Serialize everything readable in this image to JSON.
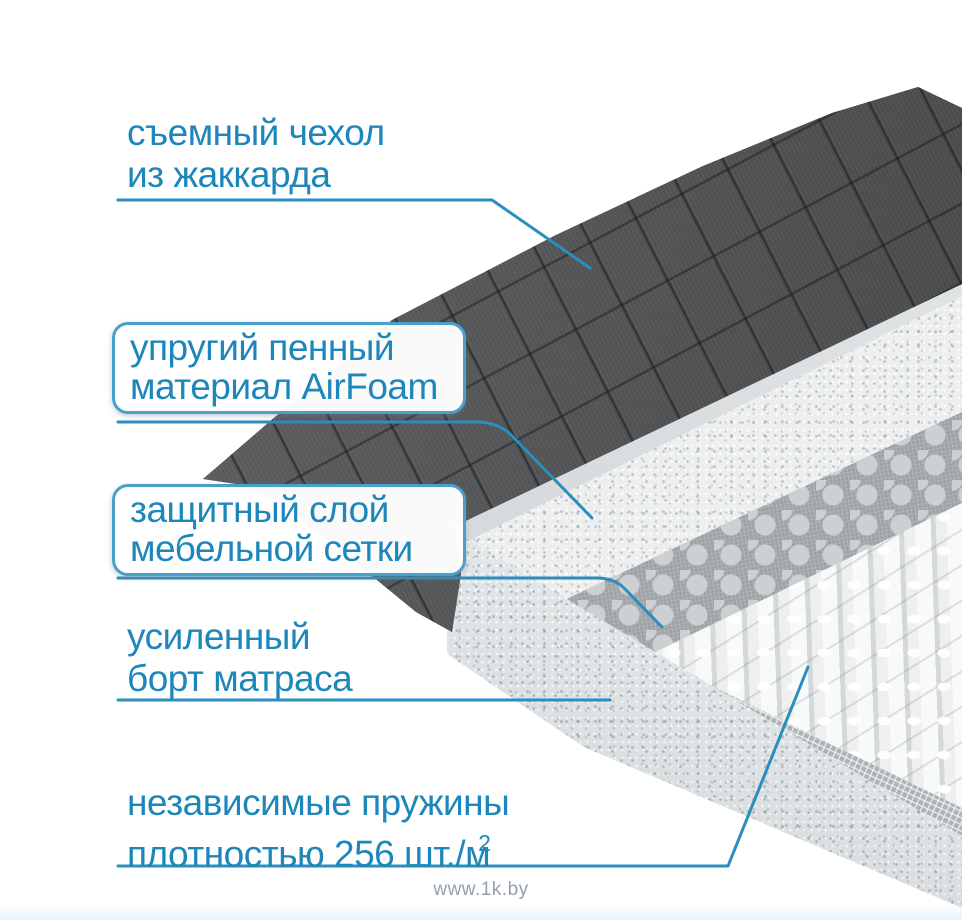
{
  "labels": [
    {
      "line1": "съемный чехол",
      "line2": "из жаккарда"
    },
    {
      "line1": "упругий пенный",
      "line2": "материал AirFoam"
    },
    {
      "line1": "защитный слой",
      "line2": "мебельной сетки"
    },
    {
      "line1": "усиленный",
      "line2": "борт матраса"
    },
    {
      "line1": "независимые пружины",
      "line2": "плотностью 256 шт./м",
      "superscript": "2"
    }
  ],
  "watermark": "www.1k.by",
  "colors": {
    "label_text": "#1d86ba",
    "leader_line": "#2b8dc0",
    "label_box_border": "#4aa0cb",
    "label_box_background": "#ffffff",
    "cover_fabric": "#56585a",
    "foam_speckle": "#eceeef",
    "mesh_layer": "#9da2a5",
    "springs": "#e7e9ea",
    "watermark_text": "#97a1aa",
    "background": "#ffffff"
  },
  "illustration_parts": [
    "jacquard-cover",
    "airfoam-layer",
    "protective-mesh-layer",
    "reinforced-border",
    "independent-pocket-springs"
  ]
}
